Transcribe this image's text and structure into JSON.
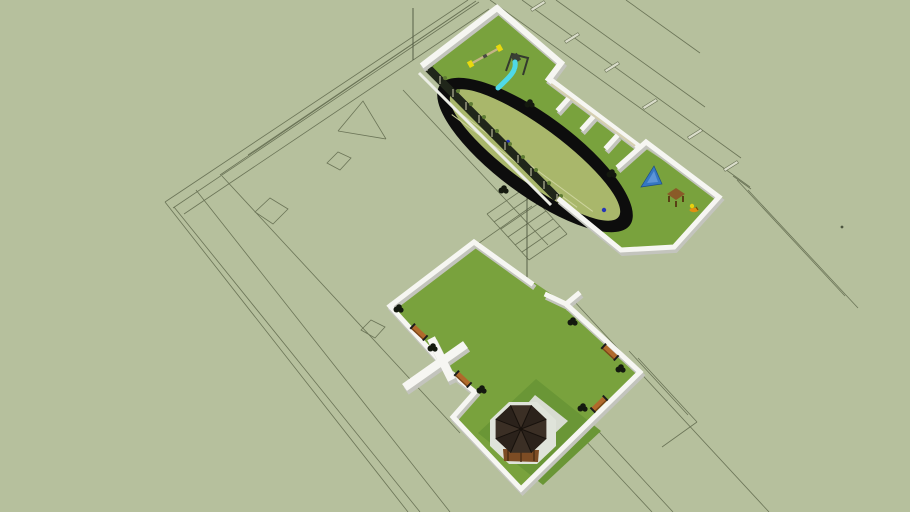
{
  "viewport": {
    "width": 910,
    "height": 512,
    "description": "3D model viewport: two walled schoolyard courtyards (playground with running track, garden with gazebo) above a 2D floor-plan wireframe underlay on sage ground"
  },
  "colors": {
    "ground": "#b6c09d",
    "plan_line": "#6b7457",
    "plan_line_dark": "#4d553f",
    "lawn": "#79a23d",
    "lawn_dark": "#6a9636",
    "infield": "#a9b76b",
    "track": "#0d0d0d",
    "track_lane": "#ccd39c",
    "wall_top": "#f6f6f2",
    "wall_side": "#c3c4bd",
    "bench_wall_top": "#d5cfb0",
    "curb": "#eceee6",
    "fence_dark": "#20261a",
    "fence_post": "#8f8f78",
    "plant": "#5f7c33",
    "bush": "#14190f",
    "bench_top": "#b06a2c",
    "bench_side": "#7c4418",
    "bench_arm": "#1c1c1c",
    "slide": "#4fd9e8",
    "seesaw_bar": "#c4b387",
    "seesaw_end": "#e8d90e",
    "swing_frame": "#343a2e",
    "equip_dark": "#3a3f35",
    "climber": "#3577c2",
    "climber_light": "#5d95d6",
    "table": "#8a5a28",
    "table_leg": "#54350f",
    "rocker_orange": "#e09012",
    "rocker_yellow": "#e8d00e",
    "gazebo_roof": "#3b2f25",
    "gazebo_roof_dark": "#2b221b",
    "gazebo_ridge": "#17110c",
    "gazebo_wall": "#7d4c24",
    "gazebo_wall_post": "#4a2d14",
    "gazebo_pad": "#dfe3da",
    "path": "#d8dcd2",
    "marker_blue": "#2636b8",
    "tick_fill": "#d9dcc9"
  },
  "scene": {
    "underlay": {
      "label": "floor plan underlay",
      "features": [
        "boundary lines",
        "interior wall lines",
        "door symbols",
        "stair treads",
        "leader lines",
        "gable outline"
      ]
    },
    "playground_courtyard": {
      "label": "playground courtyard",
      "features": [
        "perimeter walls",
        "screen fence with planting",
        "running track",
        "infield",
        "seesaw",
        "swing frame",
        "slide",
        "climbing frame",
        "picnic table",
        "spring rider",
        "shrubs",
        "track markers"
      ]
    },
    "garden_courtyard": {
      "label": "garden courtyard",
      "features": [
        "perimeter walls",
        "wall opening",
        "crossing walkway",
        "gazebo",
        "paved pad",
        "path",
        "benches",
        "shrubs",
        "dark lawn patch"
      ]
    }
  }
}
